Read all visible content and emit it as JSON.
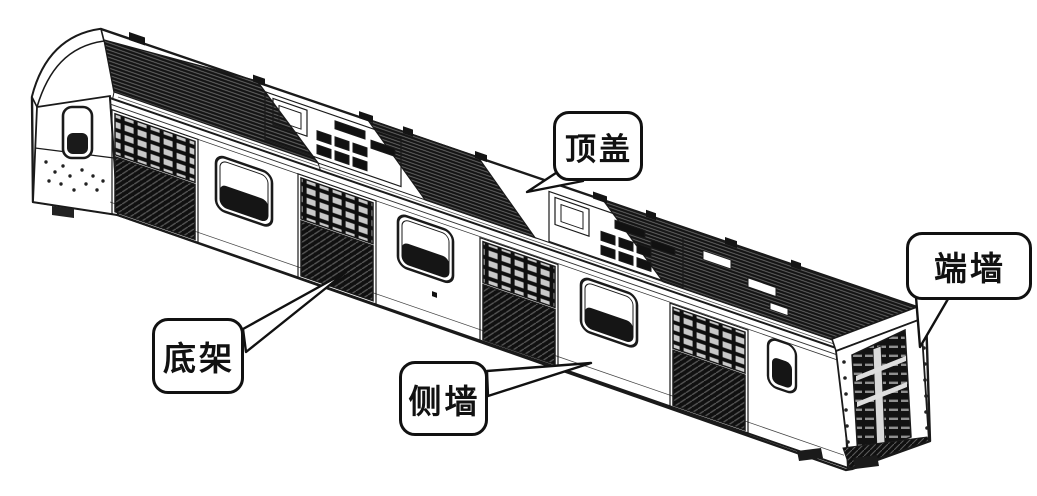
{
  "figure": {
    "subject": "rail-car-body-isometric-line-drawing",
    "background": "#ffffff",
    "ink": "#1a1a1a"
  },
  "callouts": {
    "roof": {
      "label": "顶盖"
    },
    "end_wall": {
      "label": "端墙"
    },
    "underframe": {
      "label": "底架"
    },
    "side_wall": {
      "label": "侧墙"
    }
  }
}
